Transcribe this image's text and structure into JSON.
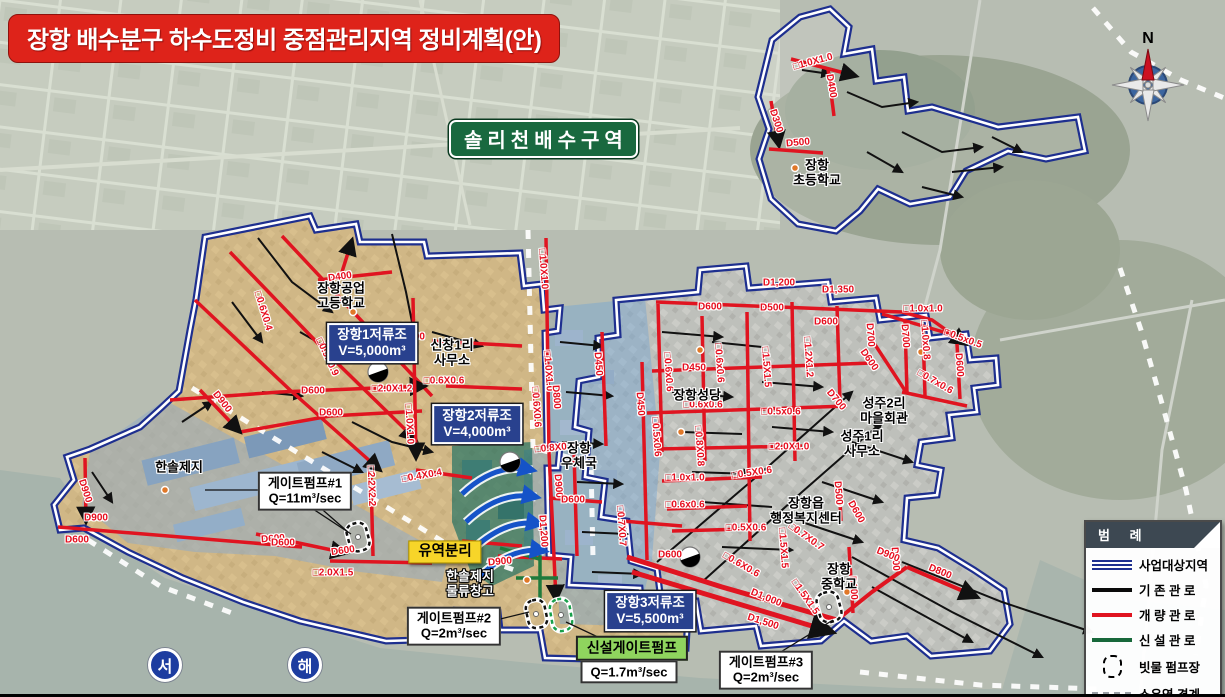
{
  "title": "장항 배수분구 하수도정비 중점관리지역 정비계획(안)",
  "region_label": "솔리천배수구역",
  "compass": {
    "north_label": "N"
  },
  "sea_labels": [
    {
      "text": "서",
      "x": 165,
      "y": 665
    },
    {
      "text": "해",
      "x": 305,
      "y": 665
    }
  ],
  "legend": {
    "title": "범 례",
    "items": [
      {
        "label": "사업대상지역",
        "type": "double-blue",
        "icon": "double-blue-line-icon",
        "color": "#1e2f8f"
      },
      {
        "label": "기 존 관 로",
        "type": "solid-black",
        "icon": "black-line-icon",
        "color": "#0a0a0a"
      },
      {
        "label": "개 량 관 로",
        "type": "solid-red",
        "icon": "red-line-icon",
        "color": "#e01420"
      },
      {
        "label": "신 설 관 로",
        "type": "solid-green",
        "icon": "green-line-icon",
        "color": "#17683a"
      },
      {
        "label": "빗물 펌프장",
        "type": "dashed-rect",
        "icon": "dashed-ellipse-icon",
        "color": "#000000"
      },
      {
        "label": "소유역 경계",
        "type": "dashed-gray",
        "icon": "gray-dashed-line-icon",
        "color": "#9aa0a6"
      }
    ]
  },
  "callouts": [
    {
      "id": "reservoir-1-label",
      "style": "blue-box",
      "x": 372,
      "y": 343,
      "lines": [
        "장항1저류조",
        "V=5,000m³"
      ]
    },
    {
      "id": "reservoir-2-label",
      "style": "blue-box",
      "x": 477,
      "y": 424,
      "lines": [
        "장항2저류조",
        "V=4,000m³"
      ]
    },
    {
      "id": "reservoir-3-label",
      "style": "blue-box",
      "x": 650,
      "y": 611,
      "lines": [
        "장항3저류조",
        "V=5,500m³"
      ]
    },
    {
      "id": "gate-pump-1-label",
      "style": "white-box",
      "x": 305,
      "y": 491,
      "lines": [
        "게이트펌프#1",
        "Q=11m³/sec"
      ]
    },
    {
      "id": "gate-pump-2-label",
      "style": "white-box",
      "x": 454,
      "y": 626,
      "lines": [
        "게이트펌프#2",
        "Q=2m³/sec"
      ]
    },
    {
      "id": "gate-pump-3-label",
      "style": "white-box",
      "x": 766,
      "y": 670,
      "lines": [
        "게이트펌프#3",
        "Q=2m³/sec"
      ]
    },
    {
      "id": "new-gate-pump-label",
      "style": "green-box",
      "x": 632,
      "y": 648,
      "lines": [
        "신설게이트펌프"
      ]
    },
    {
      "id": "new-gate-pump-q-label",
      "style": "white-box",
      "x": 629,
      "y": 672,
      "lines": [
        "Q=1.7m³/sec"
      ]
    },
    {
      "id": "basin-separation-label",
      "style": "yellow-box",
      "x": 445,
      "y": 552,
      "lines": [
        "유역분리"
      ]
    }
  ],
  "place_labels": [
    {
      "x": 341,
      "y": 296,
      "lines": [
        "장항공업",
        "고등학교"
      ]
    },
    {
      "x": 452,
      "y": 353,
      "lines": [
        "신창1리",
        "사무소"
      ]
    },
    {
      "x": 179,
      "y": 468,
      "lines": [
        "한솔제지"
      ]
    },
    {
      "x": 470,
      "y": 584,
      "lines": [
        "한솔제지",
        "물류창고"
      ],
      "inverse": true
    },
    {
      "x": 579,
      "y": 456,
      "lines": [
        "장항",
        "우체국"
      ]
    },
    {
      "x": 697,
      "y": 396,
      "lines": [
        "장항성당"
      ]
    },
    {
      "x": 884,
      "y": 411,
      "lines": [
        "성주2리",
        "마을회관"
      ]
    },
    {
      "x": 862,
      "y": 444,
      "lines": [
        "성주1리",
        "사무소"
      ]
    },
    {
      "x": 806,
      "y": 511,
      "lines": [
        "장항읍",
        "행정복지센터"
      ]
    },
    {
      "x": 839,
      "y": 577,
      "lines": [
        "장항",
        "중학교"
      ]
    },
    {
      "x": 817,
      "y": 173,
      "lines": [
        "장항",
        "초등학교"
      ]
    }
  ],
  "pipe_labels": [
    {
      "t": "D400",
      "x": 340,
      "y": 277,
      "r": -8
    },
    {
      "t": "□0.6X0.4",
      "x": 263,
      "y": 311,
      "r": 73
    },
    {
      "t": "□0.9X0.9",
      "x": 327,
      "y": 357,
      "r": 65
    },
    {
      "t": "D600",
      "x": 313,
      "y": 391,
      "r": 0
    },
    {
      "t": "D600",
      "x": 331,
      "y": 413,
      "r": 0
    },
    {
      "t": "□2.0X1.2",
      "x": 392,
      "y": 389,
      "r": 0
    },
    {
      "t": "D600",
      "x": 413,
      "y": 337,
      "r": 0
    },
    {
      "t": "□0.6X0.6",
      "x": 444,
      "y": 381,
      "r": 0
    },
    {
      "t": "□1.0X1.0",
      "x": 409,
      "y": 424,
      "r": 87
    },
    {
      "t": "□2.2X2.2",
      "x": 371,
      "y": 486,
      "r": 88
    },
    {
      "t": "□0.4X0.4",
      "x": 422,
      "y": 476,
      "r": -10
    },
    {
      "t": "D600",
      "x": 273,
      "y": 539,
      "r": -4
    },
    {
      "t": "D600",
      "x": 343,
      "y": 551,
      "r": -8
    },
    {
      "t": "□2.0X1.5",
      "x": 333,
      "y": 573,
      "r": 0
    },
    {
      "t": "D900",
      "x": 500,
      "y": 562,
      "r": -5
    },
    {
      "t": "D900",
      "x": 222,
      "y": 402,
      "r": 52
    },
    {
      "t": "D900",
      "x": 85,
      "y": 491,
      "r": 72
    },
    {
      "t": "D900",
      "x": 96,
      "y": 518,
      "r": 0
    },
    {
      "t": "D600",
      "x": 77,
      "y": 540,
      "r": 0
    },
    {
      "t": "D600",
      "x": 283,
      "y": 543,
      "r": 0
    },
    {
      "t": "□1.0X1.0",
      "x": 543,
      "y": 269,
      "r": 86
    },
    {
      "t": "□1.0X1.0",
      "x": 548,
      "y": 371,
      "r": 86
    },
    {
      "t": "D800",
      "x": 556,
      "y": 397,
      "r": 86
    },
    {
      "t": "□0.6X0.6",
      "x": 536,
      "y": 407,
      "r": 86
    },
    {
      "t": "D450",
      "x": 598,
      "y": 364,
      "r": 86
    },
    {
      "t": "D450",
      "x": 640,
      "y": 404,
      "r": 86
    },
    {
      "t": "□0.6x0.6",
      "x": 668,
      "y": 372,
      "r": 86
    },
    {
      "t": "□0.5x0.6",
      "x": 656,
      "y": 437,
      "r": 86
    },
    {
      "t": "□0.8X0.8",
      "x": 555,
      "y": 448,
      "r": -5
    },
    {
      "t": "D900",
      "x": 558,
      "y": 486,
      "r": 86
    },
    {
      "t": "D600",
      "x": 573,
      "y": 500,
      "r": 0
    },
    {
      "t": "D1,200",
      "x": 543,
      "y": 531,
      "r": 86
    },
    {
      "t": "□0.7X0.7",
      "x": 621,
      "y": 526,
      "r": 86
    },
    {
      "t": "D1,200",
      "x": 779,
      "y": 283,
      "r": 0
    },
    {
      "t": "D1,350",
      "x": 838,
      "y": 290,
      "r": 0
    },
    {
      "t": "D600",
      "x": 710,
      "y": 307,
      "r": 0
    },
    {
      "t": "D500",
      "x": 772,
      "y": 308,
      "r": 0
    },
    {
      "t": "D600",
      "x": 826,
      "y": 322,
      "r": 0
    },
    {
      "t": "D450",
      "x": 694,
      "y": 368,
      "r": 0
    },
    {
      "t": "□0.6x0.6",
      "x": 719,
      "y": 363,
      "r": 86
    },
    {
      "t": "□1.2X1.2",
      "x": 808,
      "y": 357,
      "r": 86
    },
    {
      "t": "□1.5X1.5",
      "x": 766,
      "y": 367,
      "r": 86
    },
    {
      "t": "D700",
      "x": 870,
      "y": 335,
      "r": 86
    },
    {
      "t": "D600",
      "x": 869,
      "y": 360,
      "r": 55
    },
    {
      "t": "□0.6x0.6",
      "x": 703,
      "y": 405,
      "r": 0
    },
    {
      "t": "□0.5x0.6",
      "x": 781,
      "y": 412,
      "r": 0
    },
    {
      "t": "D700",
      "x": 836,
      "y": 400,
      "r": 50
    },
    {
      "t": "□2.0X1.0",
      "x": 789,
      "y": 447,
      "r": 0
    },
    {
      "t": "□0.8X0.8",
      "x": 699,
      "y": 446,
      "r": 86
    },
    {
      "t": "□0.5X0.6",
      "x": 752,
      "y": 473,
      "r": -8
    },
    {
      "t": "□1.0x1.0",
      "x": 685,
      "y": 478,
      "r": 0
    },
    {
      "t": "□0.6x0.6",
      "x": 685,
      "y": 505,
      "r": 0
    },
    {
      "t": "□0.5X0.6",
      "x": 746,
      "y": 528,
      "r": 0
    },
    {
      "t": "□1.5X1.5",
      "x": 783,
      "y": 548,
      "r": 86
    },
    {
      "t": "□0.7X0.7",
      "x": 806,
      "y": 537,
      "r": 35
    },
    {
      "t": "D500",
      "x": 838,
      "y": 493,
      "r": 86
    },
    {
      "t": "D600",
      "x": 856,
      "y": 512,
      "r": 60
    },
    {
      "t": "D900",
      "x": 895,
      "y": 559,
      "r": 86
    },
    {
      "t": "D600",
      "x": 853,
      "y": 588,
      "r": 86
    },
    {
      "t": "D600",
      "x": 670,
      "y": 555,
      "r": 0
    },
    {
      "t": "□0.6X0.6",
      "x": 741,
      "y": 565,
      "r": 30
    },
    {
      "t": "D1,000",
      "x": 766,
      "y": 598,
      "r": 22
    },
    {
      "t": "D1,500",
      "x": 763,
      "y": 622,
      "r": 18
    },
    {
      "t": "□1.5X1.5",
      "x": 805,
      "y": 597,
      "r": 55
    },
    {
      "t": "D900",
      "x": 888,
      "y": 555,
      "r": 22
    },
    {
      "t": "D800",
      "x": 940,
      "y": 572,
      "r": 22
    },
    {
      "t": "□1.0x1.0",
      "x": 923,
      "y": 309,
      "r": 0
    },
    {
      "t": "D700",
      "x": 905,
      "y": 336,
      "r": 86
    },
    {
      "t": "□1.0x0.8",
      "x": 925,
      "y": 340,
      "r": 86
    },
    {
      "t": "□0.5x0.5",
      "x": 963,
      "y": 339,
      "r": 20
    },
    {
      "t": "D600",
      "x": 959,
      "y": 365,
      "r": 86
    },
    {
      "t": "□0.7x0.6",
      "x": 935,
      "y": 382,
      "r": 30
    },
    {
      "t": "□1.0X1.0",
      "x": 813,
      "y": 62,
      "r": -15
    },
    {
      "t": "D400",
      "x": 831,
      "y": 86,
      "r": 80
    },
    {
      "t": "D300",
      "x": 776,
      "y": 121,
      "r": 72
    },
    {
      "t": "D500",
      "x": 798,
      "y": 143,
      "r": -5
    }
  ]
}
